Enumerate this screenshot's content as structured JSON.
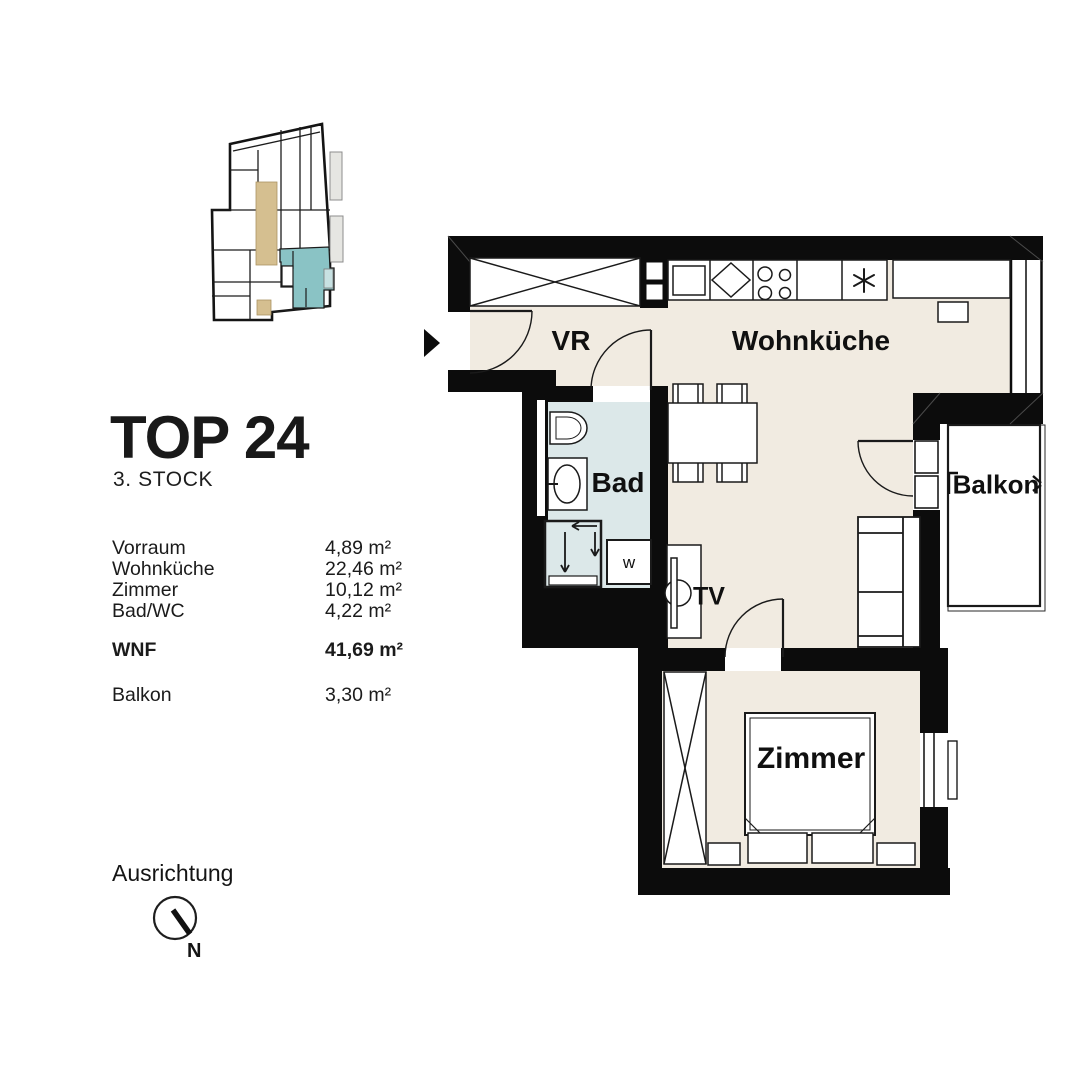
{
  "unit": {
    "title": "TOP 24",
    "floor": "3. STOCK"
  },
  "area_table": {
    "rows": [
      {
        "label": "Vorraum",
        "value": "4,89 m²"
      },
      {
        "label": "Wohnküche",
        "value": "22,46 m²"
      },
      {
        "label": "Zimmer",
        "value": "10,12 m²"
      },
      {
        "label": "Bad/WC",
        "value": "4,22 m²"
      }
    ],
    "total_row": {
      "label": "WNF",
      "value": "41,69 m²"
    },
    "balcony_row": {
      "label": "Balkon",
      "value": "3,30 m²"
    }
  },
  "compass": {
    "label": "Ausrichtung",
    "north_label": "N"
  },
  "floorplan": {
    "room_labels": {
      "vorraum": "VR",
      "wohnkueche": "Wohnküche",
      "bad": "Bad",
      "tv": "TV",
      "zimmer": "Zimmer",
      "balkon": "Balkon"
    },
    "appliance_labels": {
      "washer": "w"
    },
    "icons": {
      "vent_symbol": "six-spoke-asterisk",
      "entrance_marker": "right-arrow"
    }
  },
  "colors": {
    "wall": "#0c0c0c",
    "floor_cream": "#f1ebe1",
    "bath_floor": "#dce8e9",
    "minimap_corridor": "#d5bf90",
    "minimap_unit_teal": "#8ac3c5",
    "minimap_unit_teal_light": "#c7e1e2"
  }
}
